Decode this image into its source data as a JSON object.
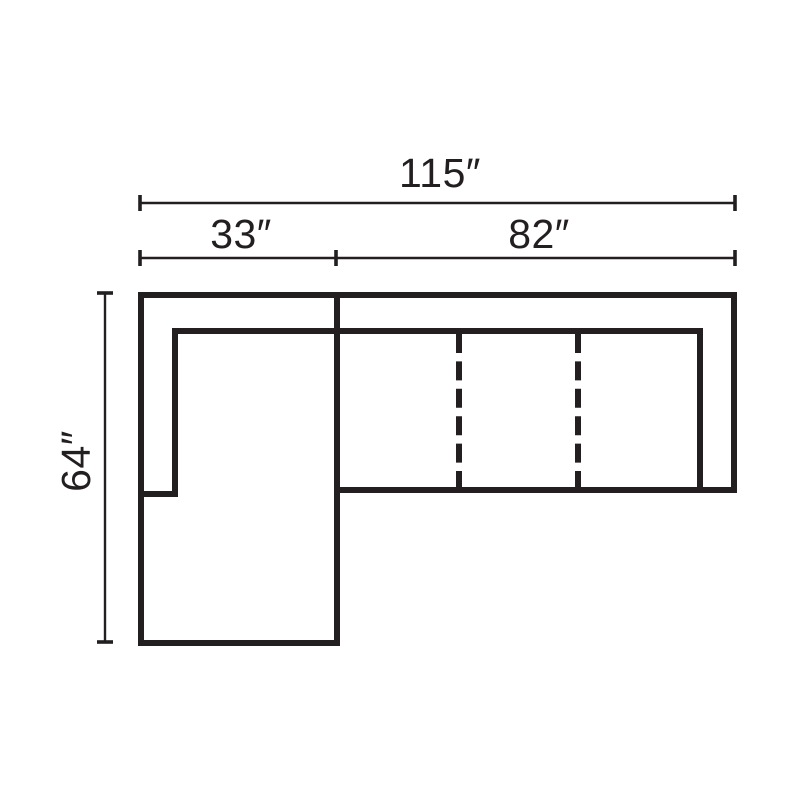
{
  "diagram": {
    "background_color": "#ffffff",
    "line_color": "#231f20",
    "labels": {
      "total_width": "115″",
      "left_section_width": "33″",
      "right_section_width": "82″",
      "depth": "64″"
    },
    "dimensions_numeric": {
      "total_width_in": 115,
      "left_section_width_in": 33,
      "right_section_width_in": 82,
      "depth_in": 64
    }
  }
}
